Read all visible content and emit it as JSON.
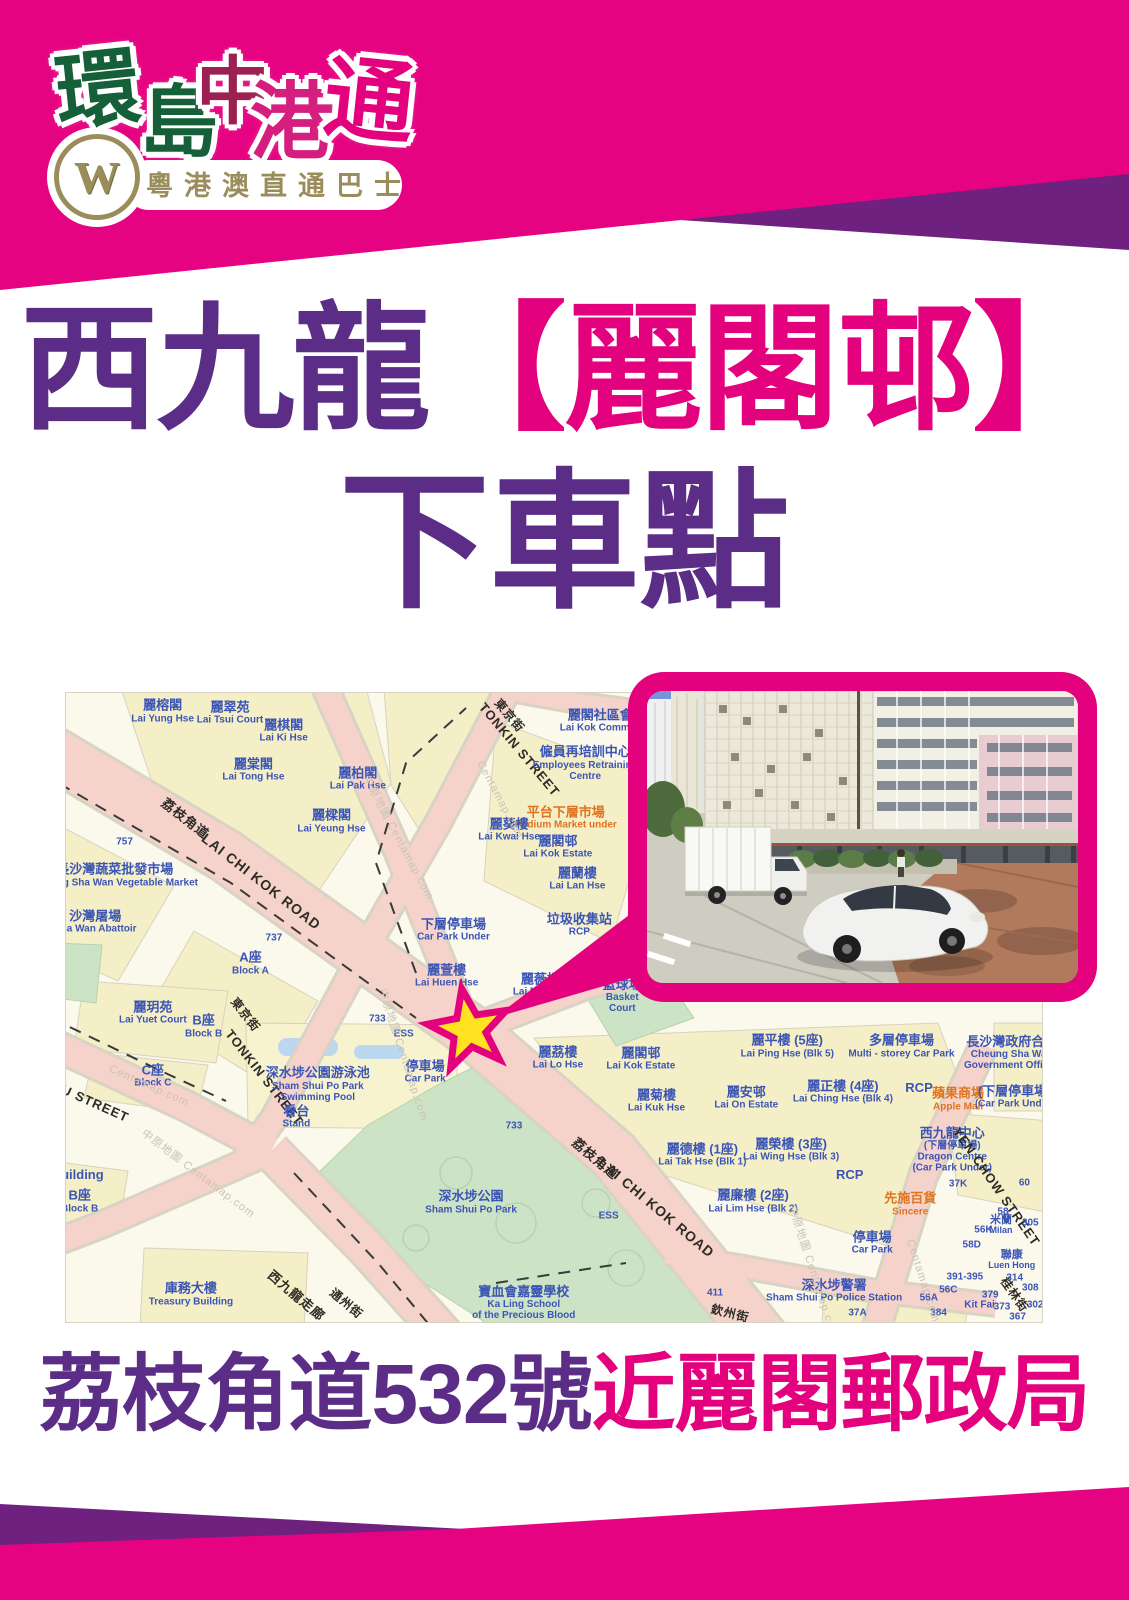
{
  "brand": {
    "monogram": "W",
    "tagline": "粵港澳直通巴士",
    "calligraphy": [
      {
        "ch": "環",
        "color": "#166039",
        "x": 8,
        "y": 16,
        "s": 84,
        "r": -6
      },
      {
        "ch": "島",
        "color": "#166039",
        "x": 92,
        "y": 50,
        "s": 78,
        "r": 0
      },
      {
        "ch": "中",
        "color": "#9c2152",
        "x": 148,
        "y": 22,
        "s": 74,
        "r": 0
      },
      {
        "ch": "港",
        "color": "#d51f7e",
        "x": 202,
        "y": 48,
        "s": 84,
        "r": 0
      },
      {
        "ch": "通",
        "color": "#e3017d",
        "x": 276,
        "y": 24,
        "s": 90,
        "r": 6
      }
    ]
  },
  "title": {
    "line1_prefix": "西九龍",
    "line1_highlight": "【麗閣邨】",
    "line2": "下車點"
  },
  "caption": {
    "part1": "荔枝角道532號",
    "part2": "近麗閣郵政局"
  },
  "colors": {
    "magenta": "#e50381",
    "purple_band": "#6f2180",
    "title_purple": "#5c2d87",
    "highlight_magenta": "#e3017d",
    "logo_gold": "#9b8d5b",
    "map_road_pink": "#f5d3ca",
    "map_park_green": "#cde3c6",
    "map_block_yellow": "#f4efc6",
    "map_label_blue": "#3b55b5",
    "map_label_orange": "#e0731f",
    "star_yellow": "#ffe220"
  },
  "map": {
    "star": {
      "x": 41.3,
      "y": 53.6
    },
    "labels": [
      {
        "t": [
          "麗榕閣",
          "Lai Yung Hse"
        ],
        "x": 9.9,
        "y": 2.9,
        "c": "bld"
      },
      {
        "t": [
          "麗翠苑",
          "Lai Tsui Court"
        ],
        "x": 16.8,
        "y": 3.2,
        "c": "bld"
      },
      {
        "t": [
          "麗棋閣",
          "Lai Ki Hse"
        ],
        "x": 22.3,
        "y": 6.0,
        "c": "bld"
      },
      {
        "t": [
          "麗棠閣",
          "Lai Tong Hse"
        ],
        "x": 19.2,
        "y": 12.2,
        "c": "bld"
      },
      {
        "t": [
          "麗柏閣",
          "Lai Pak Hse"
        ],
        "x": 29.9,
        "y": 13.6,
        "c": "bld"
      },
      {
        "t": [
          "麗樑閣",
          "Lai Yeung Hse"
        ],
        "x": 27.2,
        "y": 20.4,
        "c": "bld"
      },
      {
        "t": [
          "荔枝角道"
        ],
        "x": 12.2,
        "y": 20.0,
        "c": "st",
        "r": 38,
        "s": 13
      },
      {
        "t": [
          "LAI CHI KOK ROAD"
        ],
        "x": 20.0,
        "y": 30.0,
        "c": "st",
        "r": 38,
        "s": 14
      },
      {
        "t": [
          "757"
        ],
        "x": 6.0,
        "y": 23.7,
        "c": "num"
      },
      {
        "t": [
          "長沙灣蔬菜批發市場",
          "Cheung Sha Wan Vegetable Market"
        ],
        "x": 5.0,
        "y": 29.0,
        "c": "bld"
      },
      {
        "t": [
          "沙灣屠場",
          "Sha Wan Abattoir"
        ],
        "x": 3.0,
        "y": 36.4,
        "c": "bld"
      },
      {
        "t": [
          "737"
        ],
        "x": 21.3,
        "y": 39.0,
        "c": "num"
      },
      {
        "t": [
          "A座",
          "Block A"
        ],
        "x": 18.9,
        "y": 43.0,
        "c": "bld"
      },
      {
        "t": [
          "東京街"
        ],
        "x": 45.4,
        "y": 3.6,
        "c": "st",
        "r": 50,
        "s": 12
      },
      {
        "t": [
          "TONKIN STREET"
        ],
        "x": 46.4,
        "y": 9.0,
        "c": "st",
        "r": 50,
        "s": 13
      },
      {
        "t": [
          "麗閣社區會堂",
          "Lai Kok Community"
        ],
        "x": 55.4,
        "y": 4.4,
        "c": "bld"
      },
      {
        "t": [
          "僱員再培訓中心",
          "Employees Retraining",
          "Centre"
        ],
        "x": 53.2,
        "y": 11.2,
        "c": "bld"
      },
      {
        "t": [
          "平台下層市場",
          "Podium Market under"
        ],
        "x": 51.2,
        "y": 19.8,
        "c": "mall"
      },
      {
        "t": [
          "麗葵樓",
          "Lai Kwai Hse"
        ],
        "x": 45.4,
        "y": 21.8,
        "c": "bld"
      },
      {
        "t": [
          "麗閣邨",
          "Lai Kok Estate"
        ],
        "x": 50.4,
        "y": 24.5,
        "c": "bld"
      },
      {
        "t": [
          "麗蘭樓",
          "Lai Lan Hse"
        ],
        "x": 52.4,
        "y": 29.5,
        "c": "bld"
      },
      {
        "t": [
          "垃圾收集站",
          "RCP"
        ],
        "x": 52.6,
        "y": 36.9,
        "c": "bld"
      },
      {
        "t": [
          "下層停車場",
          "Car Park Under"
        ],
        "x": 39.7,
        "y": 37.6,
        "c": "bld"
      },
      {
        "t": [
          "麗萱樓",
          "Lai Huen Hse"
        ],
        "x": 39.0,
        "y": 45.0,
        "c": "bld"
      },
      {
        "t": [
          "麗薇樓",
          "Lai Mei Hse"
        ],
        "x": 48.6,
        "y": 46.4,
        "c": "bld"
      },
      {
        "t": [
          "籃球場",
          "Basket",
          "Court"
        ],
        "x": 57.0,
        "y": 48.2,
        "c": "bld"
      },
      {
        "t": [
          "麗玥苑",
          "Lai Yuet Court"
        ],
        "x": 8.9,
        "y": 50.8,
        "c": "bld"
      },
      {
        "t": [
          "B座",
          "Block B"
        ],
        "x": 14.1,
        "y": 53.0,
        "c": "bld"
      },
      {
        "t": [
          "C座",
          "Block C"
        ],
        "x": 8.9,
        "y": 60.9,
        "c": "bld"
      },
      {
        "t": [
          "U STREET"
        ],
        "x": 3.0,
        "y": 65.4,
        "c": "st",
        "r": 24,
        "s": 13
      },
      {
        "t": [
          "東京街"
        ],
        "x": 18.3,
        "y": 51.2,
        "c": "st",
        "r": 52,
        "s": 12
      },
      {
        "t": [
          "TONKIN STREET"
        ],
        "x": 20.3,
        "y": 61.2,
        "c": "st",
        "r": 52,
        "s": 13
      },
      {
        "t": [
          "深水埗公園游泳池",
          "Sham Shui Po Park",
          "Swimming Pool"
        ],
        "x": 25.8,
        "y": 62.2,
        "c": "bld"
      },
      {
        "t": [
          "看台",
          "Stand"
        ],
        "x": 23.6,
        "y": 67.4,
        "c": "bld"
      },
      {
        "t": [
          "停車場",
          "Car Park"
        ],
        "x": 36.8,
        "y": 60.2,
        "c": "bld"
      },
      {
        "t": [
          "733"
        ],
        "x": 31.9,
        "y": 51.8,
        "c": "num"
      },
      {
        "t": [
          "ESS"
        ],
        "x": 34.6,
        "y": 54.2,
        "c": "num"
      },
      {
        "t": [
          "深水埗公園",
          "Sham Shui Po Park"
        ],
        "x": 41.5,
        "y": 81.0,
        "c": "bld"
      },
      {
        "t": [
          "733"
        ],
        "x": 45.9,
        "y": 68.8,
        "c": "num"
      },
      {
        "t": [
          "庫務大樓",
          "Treasury Building"
        ],
        "x": 12.8,
        "y": 95.6,
        "c": "bld"
      },
      {
        "t": [
          "寶血會嘉靈學校",
          "Ka Ling School",
          "of the Precious Blood"
        ],
        "x": 46.9,
        "y": 97.0,
        "c": "bld"
      },
      {
        "t": [
          "西九龍走廊"
        ],
        "x": 23.6,
        "y": 95.8,
        "c": "st",
        "r": 40,
        "s": 13
      },
      {
        "t": [
          "通州街"
        ],
        "x": 28.7,
        "y": 97.2,
        "c": "st",
        "r": 40,
        "s": 12
      },
      {
        "t": [
          "Building"
        ],
        "x": 1.2,
        "y": 76.6,
        "c": "bld"
      },
      {
        "t": [
          "B座",
          "Block B"
        ],
        "x": 1.4,
        "y": 80.8,
        "c": "bld"
      },
      {
        "t": [
          "麗茘樓",
          "Lai Lo Hse"
        ],
        "x": 50.4,
        "y": 58.0,
        "c": "bld"
      },
      {
        "t": [
          "麗閣邨",
          "Lai Kok Estate"
        ],
        "x": 58.9,
        "y": 58.2,
        "c": "bld"
      },
      {
        "t": [
          "麗菊樓",
          "Lai Kuk Hse"
        ],
        "x": 60.5,
        "y": 64.8,
        "c": "bld"
      },
      {
        "t": [
          "麗安邨",
          "Lai On Estate"
        ],
        "x": 69.7,
        "y": 64.4,
        "c": "bld"
      },
      {
        "t": [
          "麗平樓 (5座)",
          "Lai Ping Hse (Blk 5)"
        ],
        "x": 73.9,
        "y": 56.2,
        "c": "bld"
      },
      {
        "t": [
          "多層停車場",
          "Multi - storey Car Park"
        ],
        "x": 85.6,
        "y": 56.2,
        "c": "bld"
      },
      {
        "t": [
          "長沙灣政府合署",
          "Cheung Sha Wan",
          "Government Offices"
        ],
        "x": 96.9,
        "y": 57.2,
        "c": "bld"
      },
      {
        "t": [
          "麗正樓 (4座)",
          "Lai Ching Hse (Blk 4)"
        ],
        "x": 79.6,
        "y": 63.4,
        "c": "bld"
      },
      {
        "t": [
          "RCP"
        ],
        "x": 87.4,
        "y": 62.8,
        "c": "bld"
      },
      {
        "t": [
          "蘋果商場",
          "Apple Mall"
        ],
        "x": 91.4,
        "y": 64.6,
        "c": "mall"
      },
      {
        "t": [
          "(下層停車場)",
          "(Car Park Under)"
        ],
        "x": 97.2,
        "y": 64.2,
        "c": "bld"
      },
      {
        "t": [
          "西九龍中心",
          "(下層停車場)",
          "Dragon Centre",
          "(Car Park Under)"
        ],
        "x": 90.8,
        "y": 72.6,
        "c": "bld"
      },
      {
        "t": [
          "麗德樓 (1座)",
          "Lai Tak Hse (Blk 1)"
        ],
        "x": 65.2,
        "y": 73.4,
        "c": "bld"
      },
      {
        "t": [
          "麗榮樓 (3座)",
          "Lai Wing Hse (Blk 3)"
        ],
        "x": 74.3,
        "y": 72.6,
        "c": "bld"
      },
      {
        "t": [
          "麗廉樓 (2座)",
          "Lai Lim Hse (Blk 2)"
        ],
        "x": 70.4,
        "y": 80.8,
        "c": "bld"
      },
      {
        "t": [
          "RCP"
        ],
        "x": 80.3,
        "y": 76.6,
        "c": "bld"
      },
      {
        "t": [
          "先施百貨",
          "Sincere"
        ],
        "x": 86.5,
        "y": 81.3,
        "c": "mall"
      },
      {
        "t": [
          "37K"
        ],
        "x": 91.4,
        "y": 78.0,
        "c": "num"
      },
      {
        "t": [
          "停車場",
          "Car Park"
        ],
        "x": 82.6,
        "y": 87.4,
        "c": "bld"
      },
      {
        "t": [
          "深水埗警署",
          "Sham Shui Po Police Station"
        ],
        "x": 78.7,
        "y": 95.1,
        "c": "bld"
      },
      {
        "t": [
          "YEN CHOW STREET"
        ],
        "x": 95.3,
        "y": 78.5,
        "c": "st",
        "r": 55,
        "s": 13
      },
      {
        "t": [
          "ESS"
        ],
        "x": 55.6,
        "y": 83.1,
        "c": "num"
      },
      {
        "t": [
          "411"
        ],
        "x": 66.5,
        "y": 95.4,
        "c": "num"
      },
      {
        "t": [
          "欽州街"
        ],
        "x": 68.0,
        "y": 98.8,
        "c": "st",
        "r": 14,
        "s": 12
      },
      {
        "t": [
          "桂林街"
        ],
        "x": 97.1,
        "y": 95.7,
        "c": "st",
        "r": 55,
        "s": 12
      },
      {
        "t": [
          "荔枝角道"
        ],
        "x": 54.2,
        "y": 74.1,
        "c": "st",
        "r": 40,
        "s": 13
      },
      {
        "t": [
          "LAI CHI KOK ROAD"
        ],
        "x": 60.5,
        "y": 81.8,
        "c": "st",
        "r": 40,
        "s": 14
      },
      {
        "t": [
          "米蘭",
          "Milan"
        ],
        "x": 95.8,
        "y": 84.5,
        "c": "bld",
        "s": 11
      },
      {
        "t": [
          "56K"
        ],
        "x": 94.0,
        "y": 85.4,
        "c": "num"
      },
      {
        "t": [
          "58"
        ],
        "x": 96.0,
        "y": 82.5,
        "c": "num"
      },
      {
        "t": [
          "60"
        ],
        "x": 98.2,
        "y": 77.9,
        "c": "num"
      },
      {
        "t": [
          "305"
        ],
        "x": 98.8,
        "y": 84.3,
        "c": "num"
      },
      {
        "t": [
          "聯康",
          "Luen Hong"
        ],
        "x": 96.9,
        "y": 90.1,
        "c": "bld",
        "s": 11
      },
      {
        "t": [
          "58D"
        ],
        "x": 92.8,
        "y": 87.8,
        "c": "num"
      },
      {
        "t": [
          "391-395"
        ],
        "x": 92.1,
        "y": 92.8,
        "c": "num"
      },
      {
        "t": [
          "56C"
        ],
        "x": 90.4,
        "y": 94.9,
        "c": "num"
      },
      {
        "t": [
          "56A"
        ],
        "x": 88.4,
        "y": 96.2,
        "c": "num"
      },
      {
        "t": [
          "384"
        ],
        "x": 89.4,
        "y": 98.6,
        "c": "num"
      },
      {
        "t": [
          "314"
        ],
        "x": 97.2,
        "y": 93.0,
        "c": "num"
      },
      {
        "t": [
          "308"
        ],
        "x": 98.8,
        "y": 94.6,
        "c": "num"
      },
      {
        "t": [
          "379"
        ],
        "x": 94.7,
        "y": 95.7,
        "c": "num"
      },
      {
        "t": [
          "Kit Fai"
        ],
        "x": 93.6,
        "y": 97.3,
        "c": "bld",
        "s": 10
      },
      {
        "t": [
          "373"
        ],
        "x": 95.9,
        "y": 97.6,
        "c": "num"
      },
      {
        "t": [
          "302"
        ],
        "x": 99.3,
        "y": 97.3,
        "c": "num"
      },
      {
        "t": [
          "367"
        ],
        "x": 97.5,
        "y": 99.2,
        "c": "num"
      },
      {
        "t": [
          "37A"
        ],
        "x": 81.1,
        "y": 98.6,
        "c": "num"
      },
      {
        "t": [
          "Centamap.com"
        ],
        "x": 8.5,
        "y": 62.5,
        "c": "wm",
        "r": 24
      },
      {
        "t": [
          "中原地圖 Centamap.com"
        ],
        "x": 34.0,
        "y": 23.0,
        "c": "wm",
        "r": 62
      },
      {
        "t": [
          "Centamap.com"
        ],
        "x": 44.5,
        "y": 17.0,
        "c": "wm",
        "r": 62
      },
      {
        "t": [
          "中原地圖 Centamap.com"
        ],
        "x": 13.5,
        "y": 76.5,
        "c": "wm",
        "r": 37
      },
      {
        "t": [
          "中原地圖 Centamap.com"
        ],
        "x": 34.5,
        "y": 57.5,
        "c": "wm",
        "r": 72
      },
      {
        "t": [
          "中原地圖 Centamap.com"
        ],
        "x": 76.5,
        "y": 92.0,
        "c": "wm",
        "r": 72
      },
      {
        "t": [
          "Centamap.com"
        ],
        "x": 87.8,
        "y": 93.5,
        "c": "wm",
        "r": 72
      }
    ]
  }
}
